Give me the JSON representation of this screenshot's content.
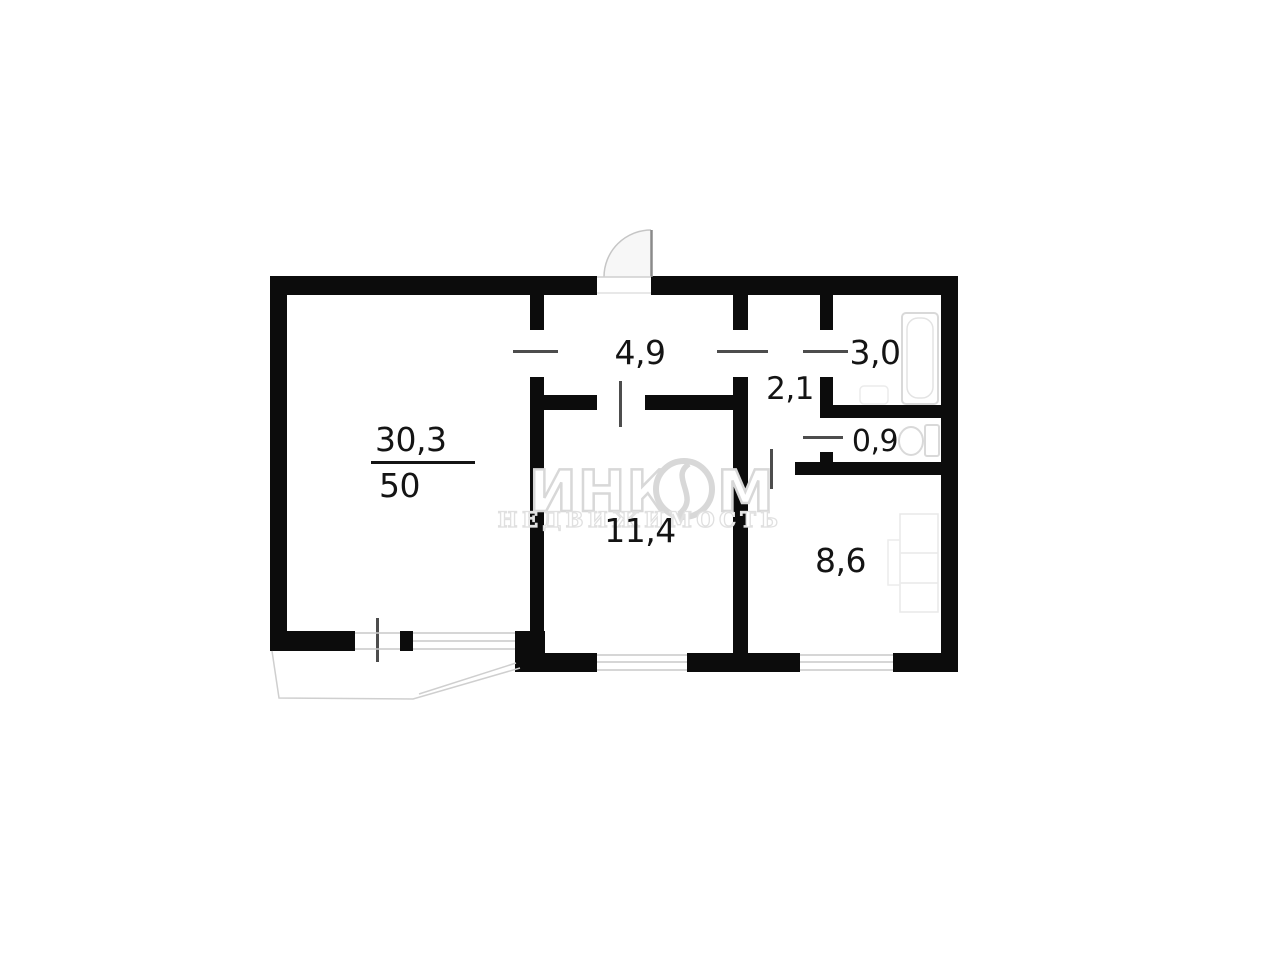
{
  "watermark": {
    "brand": "ИНКОМ",
    "brand_parts": {
      "left": "ИНК",
      "right": "М"
    },
    "tagline": "НЕДВИЖИМОСТЬ"
  },
  "plan": {
    "rooms": {
      "living": {
        "area": "30,3",
        "total": "50"
      },
      "hallway": {
        "area": "4,9"
      },
      "corridor": {
        "area": "2,1"
      },
      "bathroom": {
        "area": "3,0"
      },
      "wc": {
        "area": "0,9"
      },
      "room2": {
        "area": "11,4"
      },
      "kitchen": {
        "area": "8,6"
      }
    },
    "fixtures": [
      "bathtub",
      "toilet",
      "washbasin",
      "kitchen-counter",
      "entrance-door",
      "balcony"
    ],
    "colors": {
      "wall": "#0c0c0c",
      "tick": "#4d4d4d",
      "fixture_outline": "#d9d9d9",
      "watermark_outline": "#d8d8d8"
    }
  }
}
